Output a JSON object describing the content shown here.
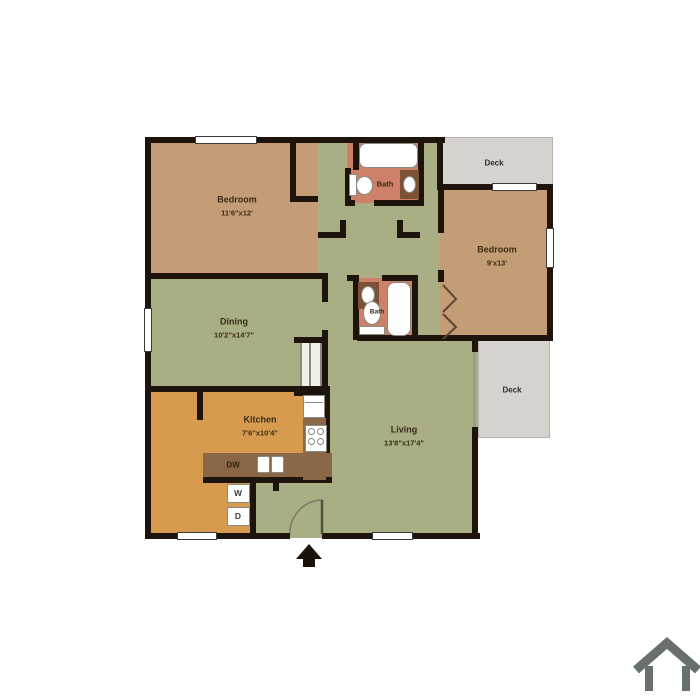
{
  "plan": {
    "rooms": {
      "bedroom1": {
        "label": "Bedroom",
        "dims": "11'6\"x12'"
      },
      "bedroom2": {
        "label": "Bedroom",
        "dims": "9'x13'"
      },
      "dining": {
        "label": "Dining",
        "dims": "10'2\"x14'7\""
      },
      "kitchen": {
        "label": "Kitchen",
        "dims": "7'6\"x10'4\""
      },
      "living": {
        "label": "Living",
        "dims": "13'8\"x17'4\""
      },
      "bath_top": {
        "label": "Bath"
      },
      "bath_mid": {
        "label": "Bath"
      },
      "deck_top": {
        "label": "Deck"
      },
      "deck_bottom": {
        "label": "Deck"
      }
    },
    "appliances": {
      "dishwasher": "DW",
      "washer": "W",
      "dryer": "D"
    },
    "icons": {
      "entry_arrow": "entry-direction-arrow",
      "house_logo": "house-outline-logo"
    },
    "colors": {
      "wall": "#1e140b",
      "bedroom_floor": "#c49c76",
      "living_floor": "#a9ae85",
      "kitchen_floor": "#d79b4f",
      "bath_floor": "#cd8168",
      "counter": "#8a6746",
      "deck_floor": "#d6d3ce",
      "label_text": "#3b2b15",
      "logo_gray": "#68706f"
    }
  }
}
